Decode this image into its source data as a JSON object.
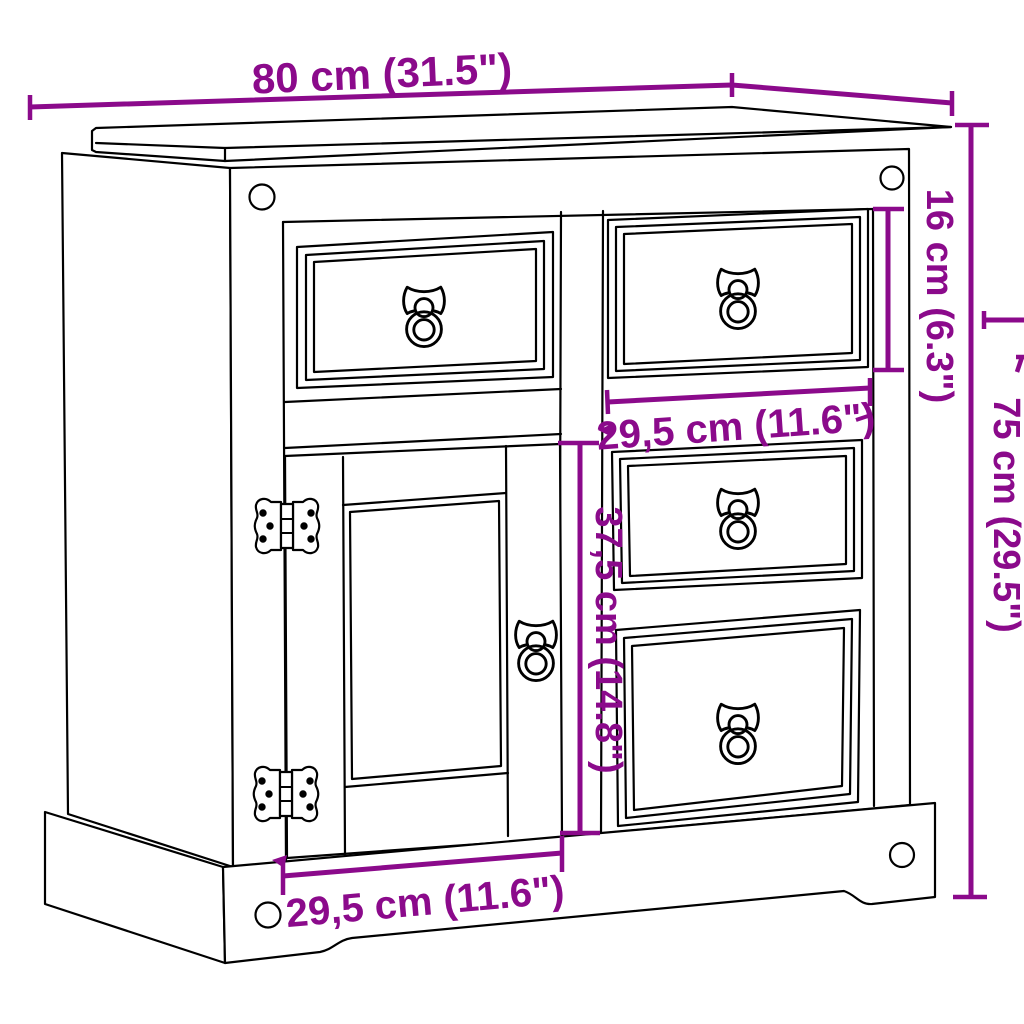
{
  "diagram": {
    "type": "furniture-dimension-drawing",
    "subject": "sideboard with one framed door, four drawers, ring pull handles and decorative hinges",
    "background_color": "#ffffff",
    "outline_color": "#000000",
    "accent_color": "#8B0A8B",
    "dimensions": {
      "overall_width": {
        "label": "80 cm (31.5\")",
        "measures": "overall width",
        "orientation": "horizontal",
        "position": "top"
      },
      "drawer_height": {
        "label": "16 cm (6.3\")",
        "measures": "top drawer height",
        "orientation": "vertical-rotated",
        "position": "upper-right"
      },
      "overall_height": {
        "label": "75 cm (29.5\")",
        "measures": "overall height",
        "orientation": "vertical-rotated",
        "position": "right"
      },
      "drawer_width": {
        "label": "29,5 cm (11.6\")",
        "measures": "drawer width",
        "orientation": "horizontal",
        "position": "middle-right"
      },
      "door_height": {
        "label": "37,5 cm (14.8\")",
        "measures": "door section height",
        "orientation": "vertical-rotated",
        "position": "center"
      },
      "door_width": {
        "label": "29,5 cm (11.6\")",
        "measures": "door width",
        "orientation": "horizontal",
        "position": "bottom-left"
      }
    }
  }
}
